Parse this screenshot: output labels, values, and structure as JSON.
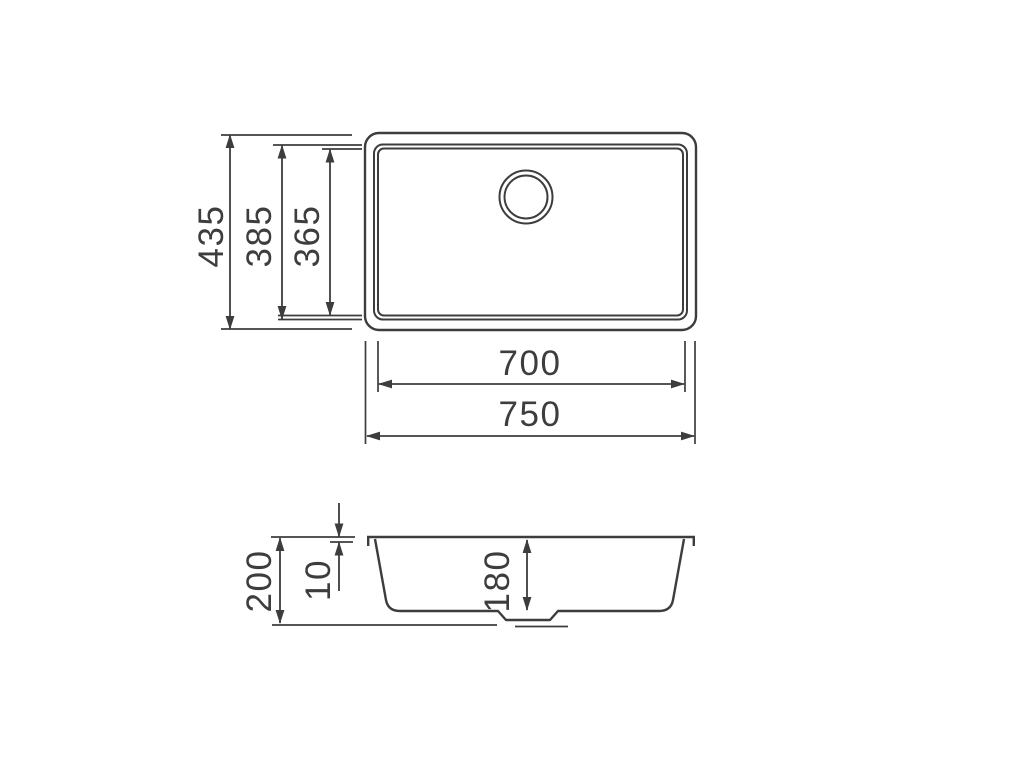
{
  "colors": {
    "line": "#3d3d3d",
    "background": "#ffffff"
  },
  "drawing": {
    "top_view": {
      "overall_height": "435",
      "outer_bowl_height": "385",
      "inner_bowl_height": "365",
      "inner_bowl_width": "700",
      "overall_width": "750"
    },
    "side_view": {
      "overall_depth": "200",
      "rim_thickness": "10",
      "bowl_depth": "180"
    }
  }
}
